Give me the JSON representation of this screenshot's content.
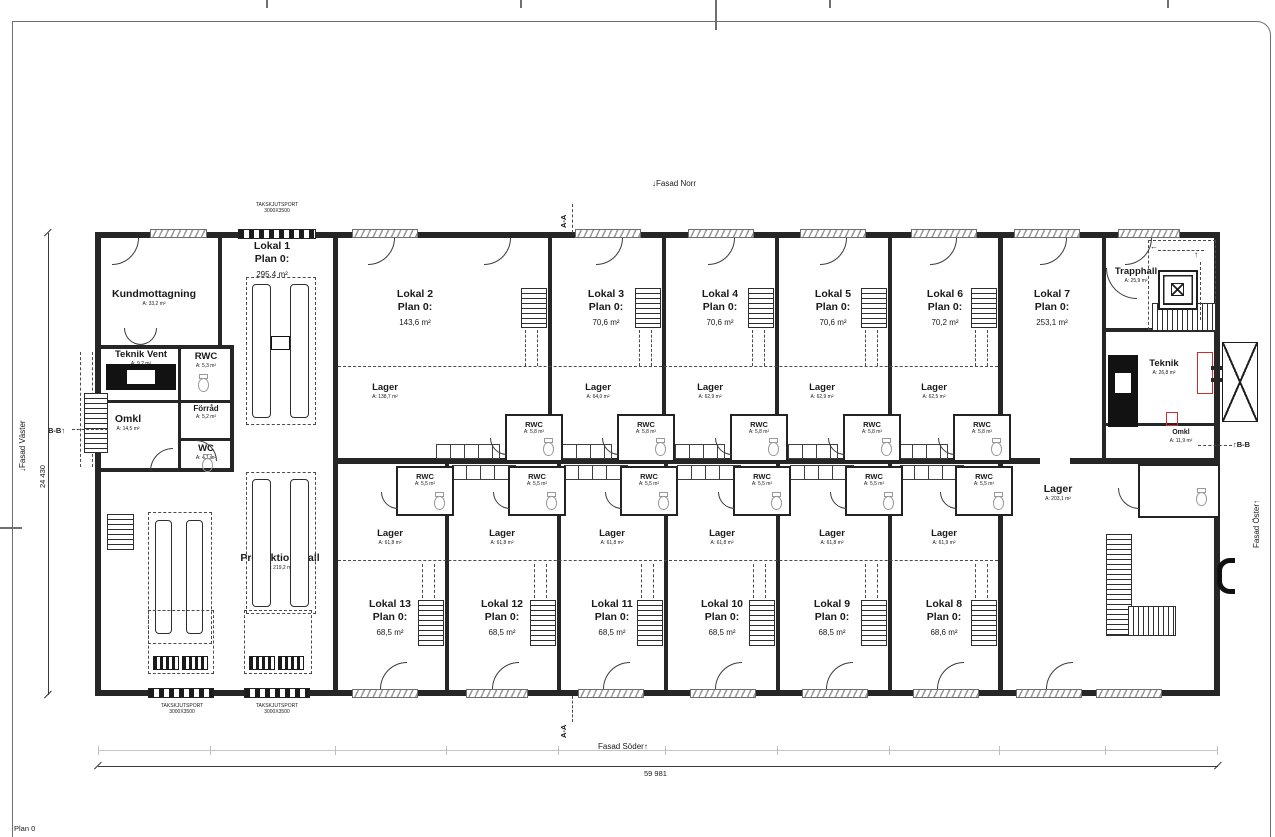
{
  "sheet": {
    "plan_label": "Plan 0"
  },
  "facades": {
    "north": "Fasad Norr",
    "south": "Fasad Söder",
    "west": "Fasad Väster",
    "east": "Fasad Öster"
  },
  "dimensions": {
    "total_width": "59 981",
    "total_height": "24 430"
  },
  "sections": {
    "aa": "A-A",
    "bb": "B-B"
  },
  "overhead_door": {
    "line1": "TAKSKJUTSPORT",
    "line2": "3000X3500"
  },
  "rooms_left": {
    "kundmottagning": {
      "name": "Kundmottagning",
      "area": "A: 33,2 m²"
    },
    "teknik_vent": {
      "name": "Teknik Vent",
      "area": "A: 9,2 m²"
    },
    "rwc": {
      "name": "RWC",
      "area": "A: 5,3 m²"
    },
    "omkl": {
      "name": "Omkl",
      "area": "A: 14,5 m²"
    },
    "forrad": {
      "name": "Förråd",
      "area": "A: 5,2 m²"
    },
    "wc": {
      "name": "WC",
      "area": "A: 4,1 m²"
    },
    "lokal1": {
      "name": "Lokal 1",
      "plan": "Plan 0:",
      "area": "295,4 m²"
    },
    "produktionshall": {
      "name": "Produktionshall",
      "area": "A: 219,2 m²"
    }
  },
  "rooms_right": {
    "lokal7": {
      "name": "Lokal 7",
      "plan": "Plan 0:",
      "area": "253,1 m²"
    },
    "trapphall": {
      "name": "Trapphall",
      "area": "A: 25,9 m²"
    },
    "teknik": {
      "name": "Teknik",
      "area": "A: 26,8 m²"
    },
    "omkl": {
      "name": "Omkl",
      "area": "A: 11,9 m²"
    },
    "rwc": {
      "name": "RWC",
      "area": "A: 5,0 m²"
    },
    "lager": {
      "name": "Lager",
      "area": "A: 203,1 m²"
    }
  },
  "units_top": [
    {
      "name": "Lokal 2",
      "plan": "Plan 0:",
      "area": "143,6 m²",
      "lager_name": "Lager",
      "lager_area": "A: 138,7 m²",
      "rwc_name": "RWC",
      "rwc_area": "A: 5,8 m²"
    },
    {
      "name": "Lokal 3",
      "plan": "Plan 0:",
      "area": "70,6 m²",
      "lager_name": "Lager",
      "lager_area": "A: 64,0 m²",
      "rwc_name": "RWC",
      "rwc_area": "A: 5,8 m²"
    },
    {
      "name": "Lokal 4",
      "plan": "Plan 0:",
      "area": "70,6 m²",
      "lager_name": "Lager",
      "lager_area": "A: 62,9 m²",
      "rwc_name": "RWC",
      "rwc_area": "A: 5,8 m²"
    },
    {
      "name": "Lokal 5",
      "plan": "Plan 0:",
      "area": "70,6 m²",
      "lager_name": "Lager",
      "lager_area": "A: 62,9 m²",
      "rwc_name": "RWC",
      "rwc_area": "A: 5,8 m²"
    },
    {
      "name": "Lokal 6",
      "plan": "Plan 0:",
      "area": "70,2 m²",
      "lager_name": "Lager",
      "lager_area": "A: 62,5 m²",
      "rwc_name": "RWC",
      "rwc_area": "A: 5,8 m²"
    }
  ],
  "units_bottom": [
    {
      "name": "Lokal 13",
      "plan": "Plan 0:",
      "area": "68,5 m²",
      "lager_name": "Lager",
      "lager_area": "A: 61,8 m²",
      "rwc_name": "RWC",
      "rwc_area": "A: 5,5 m²"
    },
    {
      "name": "Lokal 12",
      "plan": "Plan 0:",
      "area": "68,5 m²",
      "lager_name": "Lager",
      "lager_area": "A: 61,8 m²",
      "rwc_name": "RWC",
      "rwc_area": "A: 5,5 m²"
    },
    {
      "name": "Lokal 11",
      "plan": "Plan 0:",
      "area": "68,5 m²",
      "lager_name": "Lager",
      "lager_area": "A: 61,8 m²",
      "rwc_name": "RWC",
      "rwc_area": "A: 5,5 m²"
    },
    {
      "name": "Lokal 10",
      "plan": "Plan 0:",
      "area": "68,5 m²",
      "lager_name": "Lager",
      "lager_area": "A: 61,8 m²",
      "rwc_name": "RWC",
      "rwc_area": "A: 5,5 m²"
    },
    {
      "name": "Lokal 9",
      "plan": "Plan 0:",
      "area": "68,5 m²",
      "lager_name": "Lager",
      "lager_area": "A: 61,8 m²",
      "rwc_name": "RWC",
      "rwc_area": "A: 5,5 m²"
    },
    {
      "name": "Lokal 8",
      "plan": "Plan 0:",
      "area": "68,6 m²",
      "lager_name": "Lager",
      "lager_area": "A: 61,9 m²",
      "rwc_name": "RWC",
      "rwc_area": "A: 5,5 m²"
    }
  ]
}
